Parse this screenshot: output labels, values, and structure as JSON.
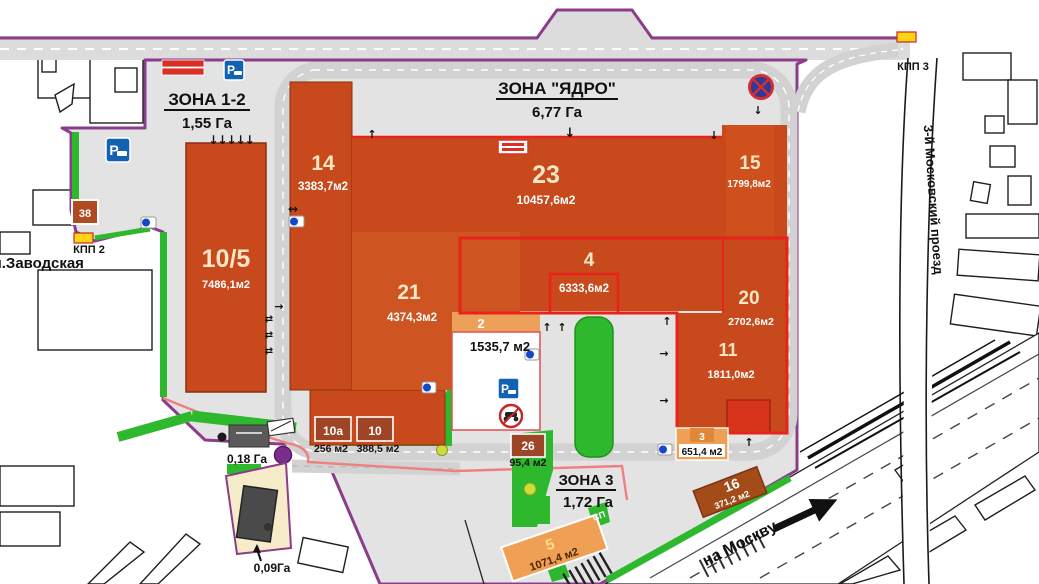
{
  "zones": [
    {
      "name": "ЗОНА 1-2",
      "area": "1,55 Га"
    },
    {
      "name": "ЗОНА \"ЯДРО\"",
      "area": "6,77 Га"
    },
    {
      "name": "ЗОНА 3",
      "area": "1,72 Га"
    }
  ],
  "buildings": {
    "b10_5": {
      "num": "10/5",
      "area": "7486,1м2"
    },
    "b14": {
      "num": "14",
      "area": "3383,7м2"
    },
    "b23": {
      "num": "23",
      "area": "10457,6м2"
    },
    "b15": {
      "num": "15",
      "area": "1799,8м2"
    },
    "b21": {
      "num": "21",
      "area": "4374,3м2"
    },
    "b4": {
      "num": "4",
      "area": "6333,6м2"
    },
    "b20": {
      "num": "20",
      "area": "2702,6м2"
    },
    "b11": {
      "num": "11",
      "area": "1811,0м2"
    },
    "b2": {
      "num": "2",
      "area": "1535,7 м2"
    },
    "b10a": {
      "num": "10а",
      "area": "256 м2"
    },
    "b10": {
      "num": "10",
      "area": "388,5 м2"
    },
    "b26": {
      "num": "26",
      "area": "95,4 м2"
    },
    "b3": {
      "num": "3",
      "area": "651,4 м2"
    },
    "b16": {
      "num": "16",
      "area": "371,2 м2"
    },
    "b5": {
      "num": "5",
      "area": "1071,4 м2"
    },
    "b38": {
      "num": "38"
    }
  },
  "labels": {
    "kpp2": "КПП 2",
    "kpp3": "КПП 3",
    "street_zavodskaya": "ул.Заводская",
    "street_moskovsky": "3-й Московский проезд",
    "to_moscow": "на Москву",
    "plot_018": "0,18 Га",
    "plot_009": "0,09Га",
    "sp": "СП"
  },
  "glyphs": {
    "down": "↓",
    "up": "↑",
    "left_right": "↔",
    "swap": "⇄",
    "right": "→",
    "five_down": "↓↓↓↓↓"
  },
  "icons": {
    "parking_letter": "P"
  },
  "colors": {
    "building_orange": "#c8491b",
    "building_light_orange": "#f0a055",
    "label_box_brown": "#9d4526",
    "green": "#2eb82e",
    "boundary_purple": "#8a3d8a",
    "red_line": "#e8231a",
    "pink_line": "#ef8080",
    "site_gray": "#e3e3e3",
    "road_gray": "#d2d2d2",
    "parking_blue": "#1262b3",
    "parcel_beige": "#f7ecc9"
  }
}
